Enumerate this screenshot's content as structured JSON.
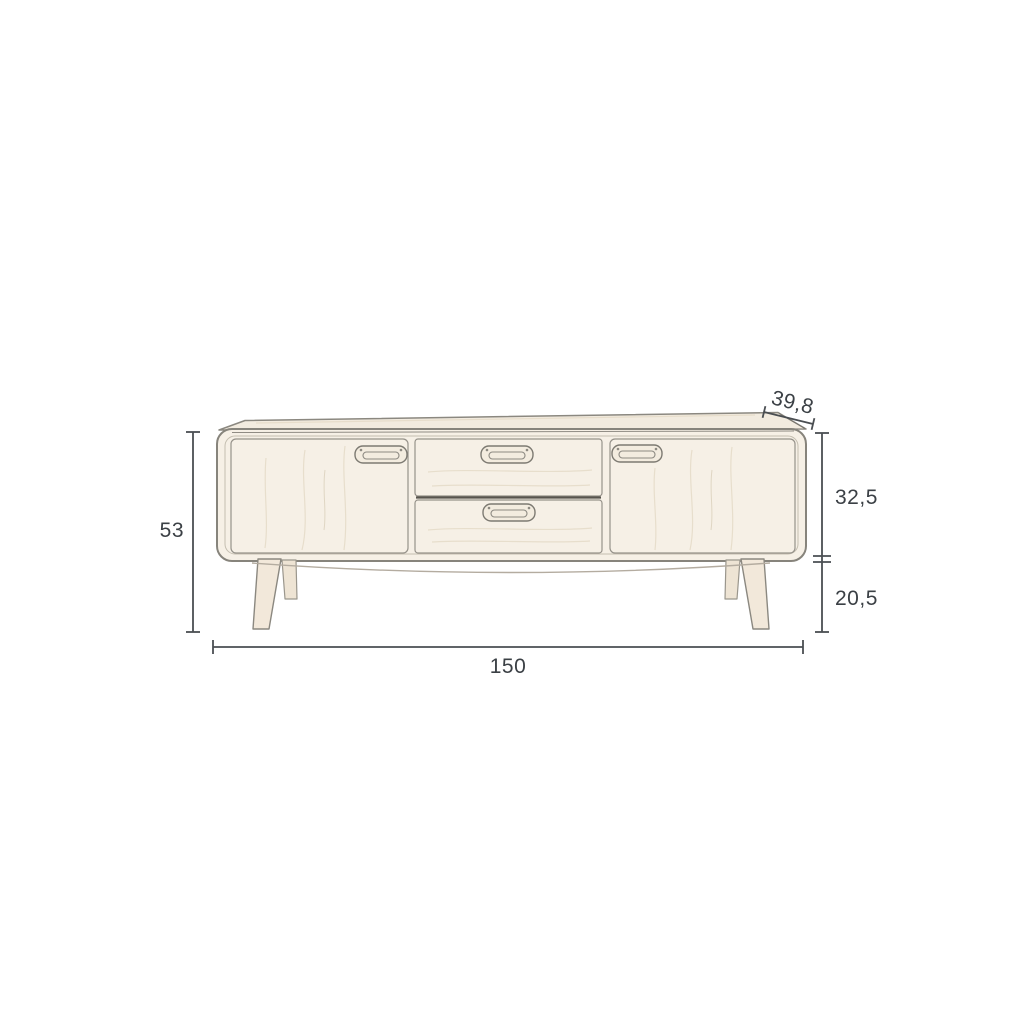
{
  "diagram": {
    "type": "furniture-dimension-drawing",
    "subject": "sideboard with two doors, two centre drawers and four splayed legs",
    "dimensions": {
      "height": {
        "label": "53",
        "placement": "vertical-left"
      },
      "width": {
        "label": "150",
        "placement": "horizontal-bottom"
      },
      "depth": {
        "label": "39,8",
        "placement": "diagonal-top-right"
      },
      "body_height": {
        "label": "32,5",
        "placement": "vertical-right-upper"
      },
      "leg_height": {
        "label": "20,5",
        "placement": "vertical-right-lower"
      }
    },
    "colors": {
      "background": "#ffffff",
      "dimension_line": "#4a4e52",
      "dimension_text": "#3b4045",
      "furniture_fill": "#f6f0e6",
      "furniture_outline": "#87847c",
      "leg_fill": "#f2e8da"
    }
  }
}
